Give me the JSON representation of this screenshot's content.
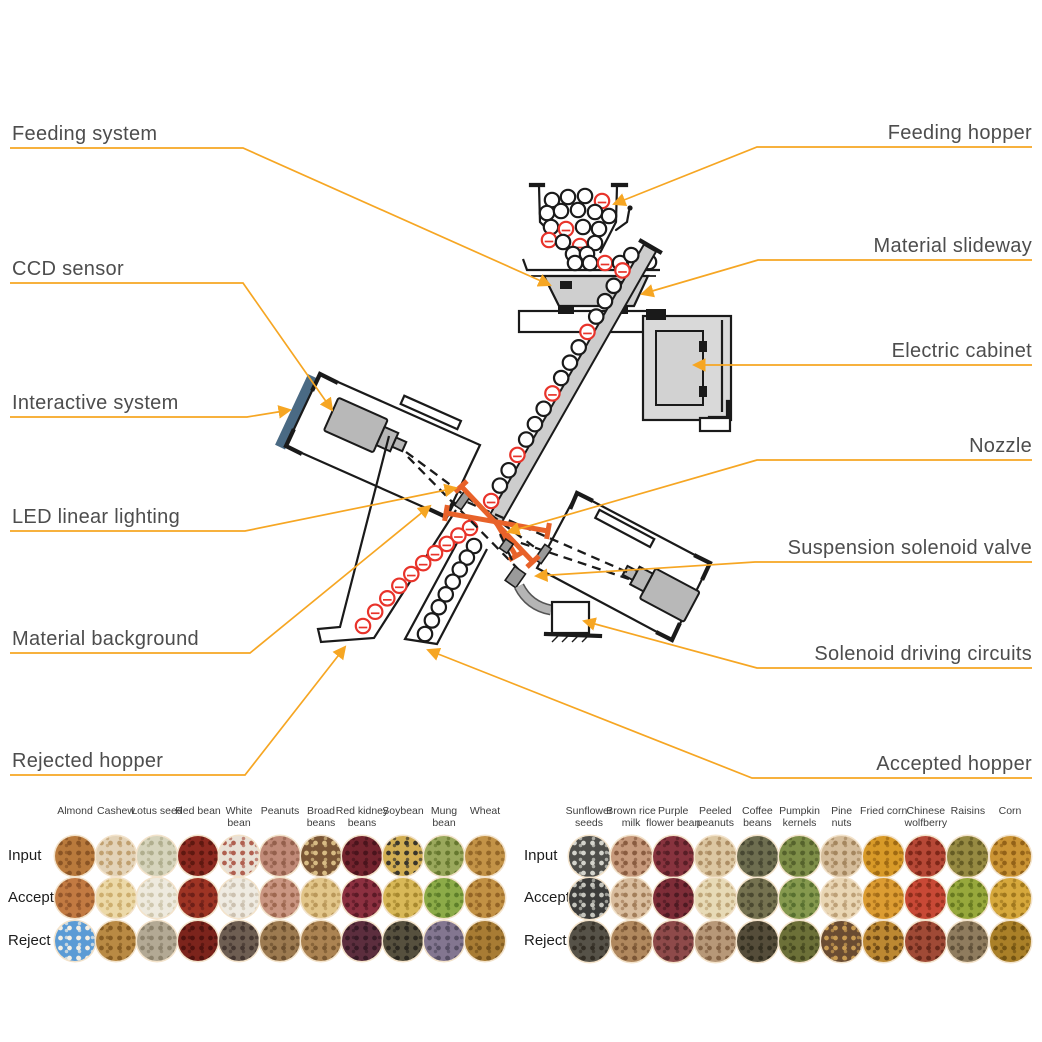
{
  "colors": {
    "leader_line": "#F6A623",
    "reject_red": "#E8332A",
    "led_beam": "#E8622A",
    "outline": "#1A1A1A",
    "cabinet_gray": "#D9D9D9",
    "camera_gray": "#B8B8B8",
    "screen_blue": "#4A6A84",
    "label_text": "#4D4D4D"
  },
  "labels": {
    "feeding_system": "Feeding system",
    "ccd_sensor": "CCD sensor",
    "interactive_system": "Interactive system",
    "led_linear_lighting": "LED linear lighting",
    "material_background": "Material background",
    "rejected_hopper": "Rejected hopper",
    "feeding_hopper": "Feeding hopper",
    "material_slideway": "Material slideway",
    "electric_cabinet": "Electric cabinet",
    "nozzle": "Nozzle",
    "suspension_solenoid_valve": "Suspension solenoid valve",
    "solenoid_driving_circuits": "Solenoid driving circuits",
    "accepted_hopper": "Accepted hopper"
  },
  "tables": [
    {
      "row_labels": [
        "Input",
        "Accept",
        "Reject"
      ],
      "columns": [
        "Almond",
        "Cashew",
        "Lotus seed",
        "Red bean",
        "White\nbean",
        "Peanuts",
        "Broad\nbeans",
        "Red kidney\nbeans",
        "Soybean",
        "Mung\nbean",
        "Wheat"
      ],
      "cells": [
        [
          [
            "#b97a3c",
            "#8a5424"
          ],
          [
            "#e3d3b8",
            "#c0a070"
          ],
          [
            "#d6d4bc",
            "#b0ae8e"
          ],
          [
            "#8e2a20",
            "#5e1810"
          ],
          [
            "#e9e1d6",
            "#b06050"
          ],
          [
            "#c08a78",
            "#94604c"
          ],
          [
            "#7a5636",
            "#d8bc84"
          ],
          [
            "#74242e",
            "#4a141c"
          ],
          [
            "#d2ae52",
            "#3a362c"
          ],
          [
            "#9aa85c",
            "#66782f"
          ],
          [
            "#c39347",
            "#936627"
          ]
        ],
        [
          [
            "#c27a42",
            "#94562a"
          ],
          [
            "#ecd9a8",
            "#cdae6e"
          ],
          [
            "#eeeade",
            "#cfc7ae"
          ],
          [
            "#9e3424",
            "#6e2018"
          ],
          [
            "#efebe2",
            "#ccc1b0"
          ],
          [
            "#ca9682",
            "#9e6850"
          ],
          [
            "#e2c68a",
            "#ba985a"
          ],
          [
            "#8c3040",
            "#5c1a26"
          ],
          [
            "#d8b858",
            "#a8892f"
          ],
          [
            "#8cab48",
            "#5e7f2a"
          ],
          [
            "#c29144",
            "#946425"
          ]
        ],
        [
          [
            "#5b9bd5",
            "#f4efe4"
          ],
          [
            "#b98a44",
            "#865c22"
          ],
          [
            "#b3a994",
            "#8c826c"
          ],
          [
            "#7c241c",
            "#50120e"
          ],
          [
            "#6e5e52",
            "#443630"
          ],
          [
            "#9c7a50",
            "#6c4f2e"
          ],
          [
            "#ab8352",
            "#7a5830"
          ],
          [
            "#5c2e3e",
            "#371a26"
          ],
          [
            "#56503e",
            "#2b2820"
          ],
          [
            "#837690",
            "#564e64"
          ],
          [
            "#a87c34",
            "#76531c"
          ]
        ]
      ]
    },
    {
      "row_labels": [
        "Input",
        "Accept",
        "Reject"
      ],
      "columns": [
        "Sunflower\nseeds",
        "Brown rice\nmilk",
        "Purple\nflower bean",
        "Peeled\npeanuts",
        "Coffee\nbeans",
        "Pumpkin\nkernels",
        "Pine\nnuts",
        "Fried corn",
        "Chinese\nwolfberry",
        "Raisins",
        "Corn"
      ],
      "cells": [
        [
          [
            "#4e4e4a",
            "#d4d4cc"
          ],
          [
            "#c79a7c",
            "#8a5c40"
          ],
          [
            "#87333e",
            "#581e26"
          ],
          [
            "#dcc7a2",
            "#ad8e64"
          ],
          [
            "#6e6e50",
            "#474732"
          ],
          [
            "#7e8e48",
            "#55622c"
          ],
          [
            "#d5bd9b",
            "#a5875f"
          ],
          [
            "#d89a28",
            "#a06a12"
          ],
          [
            "#b64836",
            "#7e2618"
          ],
          [
            "#968a42",
            "#655c24"
          ],
          [
            "#cb9434",
            "#936218"
          ]
        ],
        [
          [
            "#3c3c3a",
            "#c4c4bc"
          ],
          [
            "#d9bd9e",
            "#a37e5a"
          ],
          [
            "#7e2d38",
            "#4e1a22"
          ],
          [
            "#e7dab6",
            "#bfa679"
          ],
          [
            "#757250",
            "#4b4930"
          ],
          [
            "#85994e",
            "#587030"
          ],
          [
            "#e9d6b4",
            "#bda077"
          ],
          [
            "#dc9c32",
            "#a66e18"
          ],
          [
            "#c84936",
            "#8e2d1b"
          ],
          [
            "#97a83c",
            "#687a20"
          ],
          [
            "#d6a83c",
            "#a0781e"
          ]
        ],
        [
          [
            "#565248",
            "#322d24"
          ],
          [
            "#b0885e",
            "#7a5534"
          ],
          [
            "#8e4a4a",
            "#5c2c2c"
          ],
          [
            "#b79878",
            "#836244"
          ],
          [
            "#554d3a",
            "#322e1f"
          ],
          [
            "#6c7038",
            "#45481f"
          ],
          [
            "#6a4c32",
            "#c89b52"
          ],
          [
            "#bc8832",
            "#6a4614"
          ],
          [
            "#a04a36",
            "#68281a"
          ],
          [
            "#8f7c5e",
            "#5e4f38"
          ],
          [
            "#aa8028",
            "#745412"
          ]
        ]
      ]
    }
  ]
}
